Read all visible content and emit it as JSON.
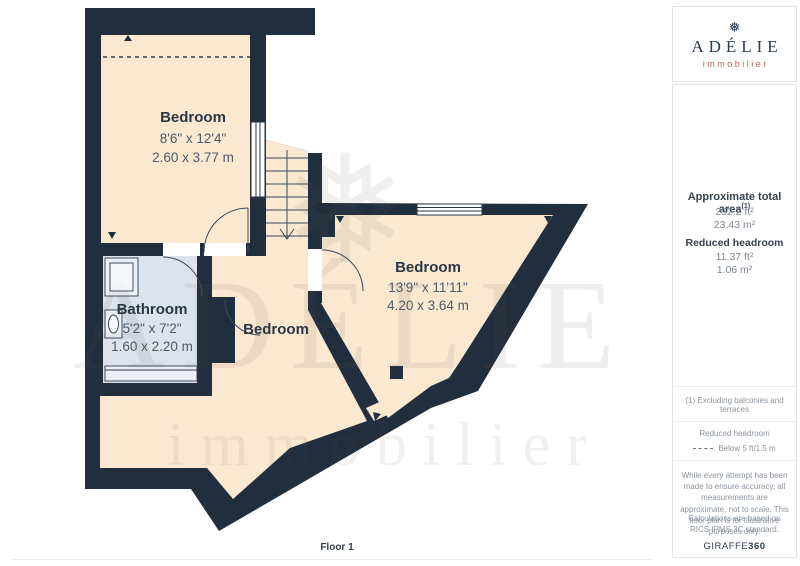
{
  "icons": {
    "snowflake": "❅"
  },
  "colors": {
    "wall": "#212e3d",
    "room_fill": "#fbe8d1",
    "bathroom_fill": "#dce2ee",
    "brand_navy": "#2d3c4f",
    "brand_accent": "#c05f58"
  },
  "floorplan": {
    "floor_label": "Floor 1",
    "watermark": {
      "brand": "ADÉLIE",
      "tagline": "immobilier"
    },
    "rooms": [
      {
        "name": "Bedroom",
        "imperial": "8'6\" x 12'4\"",
        "metric": "2.60 x 3.77 m"
      },
      {
        "name": "Bathroom",
        "imperial": "5'2\" x 7'2\"",
        "metric": "1.60 x 2.20 m"
      },
      {
        "name": "Bedroom"
      },
      {
        "name": "Bedroom",
        "imperial": "13'9\" x 11'11\"",
        "metric": "4.20 x 3.64 m"
      }
    ]
  },
  "sidebar": {
    "logo": {
      "brand": "ADÉLIE",
      "tagline": "immobilier"
    },
    "area": {
      "title": "Approximate total area",
      "title_sup": "(1)",
      "total_ft": "252.2 ft²",
      "total_m": "23.43 m²",
      "reduced_label": "Reduced headroom",
      "reduced_ft": "11.37 ft²",
      "reduced_m": "1.06 m²"
    },
    "note": "(1) Excluding balconies and terraces",
    "legend": {
      "title": "Reduced headroom",
      "label": "Below 5 ft/1.5 m"
    },
    "disclaimer": {
      "p1": "While every attempt has been made to ensure accuracy, all measurements are approximate, not to scale. This floor plan is for illustrative purposes only.",
      "p2": "Calculations are based on RICS IPMS 3C standard."
    },
    "brand_footer": {
      "name": "GIRAFFE",
      "suffix": "360"
    }
  }
}
